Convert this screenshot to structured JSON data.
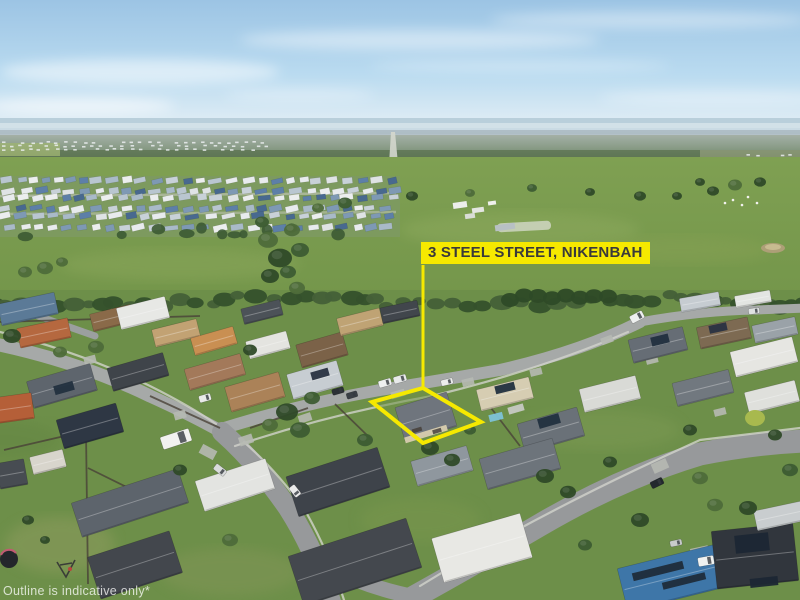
{
  "overlay": {
    "address_label": "3 STEEL STREET, NIKENBAH",
    "disclaimer": "Outline is indicative only*",
    "colors": {
      "highlight": "#f6e900",
      "label_bg": "#f6e900",
      "label_text": "#3a3a3a",
      "watermark": "rgba(255,255,255,0.75)"
    }
  },
  "scene": {
    "outline": {
      "points": "423,388 481,422 423,443 372,402",
      "leader": [
        423,
        265,
        423,
        388
      ],
      "stroke_width": 4
    },
    "estate": {
      "rows": [
        181.5,
        190,
        198.5,
        207.5,
        217,
        226.5
      ],
      "x0": 2,
      "x1": 396,
      "palette": [
        "#e8ebed",
        "#c8d1d8",
        "#5d7fa8",
        "#48698f",
        "#a9bac8",
        "#dfe3e4",
        "#7e99b4",
        "#eceeee",
        "#b9c6d0"
      ]
    },
    "houses": [
      [
        28,
        309,
        58,
        22,
        -12,
        "#5b7a97"
      ],
      [
        44,
        333,
        52,
        20,
        -12,
        "#b5683f"
      ],
      [
        112,
        318,
        42,
        18,
        -14,
        "#8a6a49"
      ],
      [
        143,
        313,
        50,
        22,
        -14,
        "#e7e8e5"
      ],
      [
        176,
        333,
        46,
        18,
        -14,
        "#c2a273"
      ],
      [
        214,
        341,
        44,
        18,
        -16,
        "#c98f52"
      ],
      [
        262,
        312,
        40,
        16,
        -14,
        "#4c5258"
      ],
      [
        268,
        345,
        42,
        18,
        -15,
        "#e4e4e0"
      ],
      [
        322,
        350,
        48,
        24,
        -16,
        "#7b6248"
      ],
      [
        360,
        322,
        44,
        18,
        -14,
        "#bfa374"
      ],
      [
        400,
        312,
        38,
        16,
        -12,
        "#41464c"
      ],
      [
        215,
        372,
        58,
        22,
        -16,
        "#a3795a"
      ],
      [
        255,
        392,
        56,
        26,
        -16,
        "#ab8258"
      ],
      [
        315,
        380,
        52,
        26,
        -16,
        "#c7cdd2"
      ],
      [
        505,
        394,
        54,
        22,
        -14,
        "#d6cdb2"
      ],
      [
        551,
        430,
        62,
        30,
        -16,
        "#6a7178"
      ],
      [
        610,
        394,
        58,
        24,
        -14,
        "#d9dad6"
      ],
      [
        658,
        345,
        56,
        24,
        -14,
        "#666d75"
      ],
      [
        724,
        333,
        52,
        22,
        -12,
        "#7d6a52"
      ],
      [
        700,
        302,
        40,
        14,
        -10,
        "#c6ccd1"
      ],
      [
        753,
        299,
        36,
        12,
        -10,
        "#e3e5e2"
      ],
      [
        775,
        330,
        44,
        18,
        -12,
        "#9aa2a8"
      ],
      [
        764,
        357,
        64,
        26,
        -14,
        "#e6e6e2"
      ],
      [
        703,
        388,
        58,
        24,
        -14,
        "#71787f"
      ],
      [
        772,
        397,
        52,
        22,
        -14,
        "#dfe0dc"
      ],
      [
        62,
        386,
        66,
        28,
        -16,
        "#5e656d"
      ],
      [
        138,
        372,
        58,
        24,
        -16,
        "#3f444a"
      ],
      [
        90,
        426,
        62,
        30,
        -16,
        "#2e3744"
      ],
      [
        15,
        408,
        36,
        26,
        -8,
        "#b55f38"
      ],
      [
        130,
        503,
        112,
        36,
        -18,
        "#5d646c"
      ],
      [
        135,
        565,
        86,
        44,
        -18,
        "#43474d"
      ],
      [
        48,
        462,
        34,
        18,
        -14,
        "#d8d5cc"
      ],
      [
        12,
        474,
        28,
        26,
        -10,
        "#474c52"
      ],
      [
        235,
        485,
        74,
        32,
        -18,
        "#e3e4e1"
      ],
      [
        338,
        482,
        96,
        42,
        -18,
        "#3e434a"
      ],
      [
        355,
        562,
        124,
        52,
        -18,
        "#44484e"
      ],
      [
        482,
        548,
        92,
        46,
        -16,
        "#e8e8e4"
      ],
      [
        520,
        464,
        76,
        32,
        -16,
        "#6d747b"
      ],
      [
        442,
        466,
        58,
        26,
        -16,
        "#8f979e"
      ],
      [
        675,
        577,
        108,
        44,
        -14,
        "#3e76a8"
      ],
      [
        755,
        556,
        82,
        58,
        -6,
        "#31363d"
      ],
      [
        779,
        516,
        48,
        20,
        -12,
        "#c9cdcf"
      ],
      [
        426,
        417,
        54,
        36,
        -17,
        "#6f757d"
      ]
    ],
    "house_details": [
      [
        426,
        434,
        44,
        6,
        -17,
        "#d8cdaf"
      ],
      [
        417,
        430,
        10,
        4,
        -17,
        "#4a4540"
      ],
      [
        437,
        431,
        9,
        4,
        -17,
        "#565049"
      ],
      [
        505,
        388,
        20,
        8,
        -14,
        "#22303f"
      ],
      [
        549,
        421,
        22,
        10,
        -16,
        "#22303f"
      ],
      [
        660,
        340,
        18,
        9,
        -14,
        "#22303f"
      ],
      [
        718,
        328,
        18,
        8,
        -12,
        "#2a3342"
      ],
      [
        64,
        388,
        20,
        9,
        -16,
        "#22303f"
      ],
      [
        658,
        571,
        52,
        8,
        -14,
        "#1f2c3a"
      ],
      [
        684,
        581,
        44,
        7,
        -14,
        "#1f2c3a"
      ],
      [
        752,
        543,
        34,
        18,
        -6,
        "#1c2734"
      ],
      [
        764,
        582,
        28,
        9,
        -6,
        "#1c2734"
      ],
      [
        496,
        417,
        14,
        7,
        -14,
        "#7ec3d8"
      ],
      [
        516,
        409,
        16,
        7,
        -16,
        "#c7c9c4"
      ],
      [
        320,
        374,
        18,
        8,
        -16,
        "#2a3342"
      ]
    ],
    "trees": [
      [
        268,
        240,
        10
      ],
      [
        280,
        258,
        12
      ],
      [
        270,
        276,
        9
      ],
      [
        292,
        230,
        8
      ],
      [
        300,
        250,
        9
      ],
      [
        288,
        272,
        8
      ],
      [
        262,
        222,
        7
      ],
      [
        297,
        288,
        8
      ],
      [
        318,
        208,
        6
      ],
      [
        345,
        203,
        7
      ],
      [
        412,
        196,
        6
      ],
      [
        470,
        193,
        5
      ],
      [
        532,
        188,
        5
      ],
      [
        590,
        192,
        5
      ],
      [
        640,
        196,
        6
      ],
      [
        677,
        196,
        5
      ],
      [
        713,
        191,
        6
      ],
      [
        735,
        185,
        7
      ],
      [
        760,
        182,
        6
      ],
      [
        700,
        182,
        5
      ],
      [
        45,
        268,
        8
      ],
      [
        25,
        272,
        7
      ],
      [
        62,
        262,
        6
      ],
      [
        12,
        336,
        9
      ],
      [
        60,
        352,
        7
      ],
      [
        96,
        347,
        8
      ],
      [
        250,
        350,
        7
      ],
      [
        287,
        412,
        11
      ],
      [
        300,
        430,
        10
      ],
      [
        270,
        425,
        8
      ],
      [
        312,
        398,
        8
      ],
      [
        430,
        448,
        9
      ],
      [
        452,
        460,
        8
      ],
      [
        545,
        476,
        9
      ],
      [
        610,
        462,
        7
      ],
      [
        568,
        492,
        8
      ],
      [
        640,
        520,
        9
      ],
      [
        700,
        478,
        8
      ],
      [
        748,
        508,
        9
      ],
      [
        790,
        470,
        8
      ],
      [
        230,
        540,
        8
      ],
      [
        180,
        470,
        7
      ],
      [
        365,
        440,
        8
      ],
      [
        470,
        430,
        6
      ],
      [
        690,
        430,
        7
      ],
      [
        775,
        435,
        7
      ],
      [
        715,
        505,
        8
      ],
      [
        585,
        545,
        7
      ],
      [
        28,
        520,
        6
      ],
      [
        45,
        540,
        5
      ]
    ],
    "lime_tree": [
      755,
      418,
      10,
      "#a8b94e"
    ],
    "vehicles": [
      [
        176,
        439,
        30,
        13,
        -18,
        "#f2f2ef"
      ],
      [
        385,
        383,
        13,
        7,
        -16,
        "#eef0f0"
      ],
      [
        400,
        379,
        13,
        7,
        -16,
        "#e8eaea"
      ],
      [
        447,
        382,
        12,
        6,
        -14,
        "#eceeec"
      ],
      [
        205,
        398,
        12,
        7,
        -16,
        "#e9ebe9"
      ],
      [
        338,
        391,
        12,
        6,
        -16,
        "#2c3136"
      ],
      [
        352,
        395,
        11,
        6,
        -16,
        "#3a3f45"
      ],
      [
        220,
        470,
        13,
        7,
        38,
        "#d9dbdb"
      ],
      [
        295,
        491,
        12,
        7,
        52,
        "#eaeaea"
      ],
      [
        637,
        317,
        14,
        8,
        -28,
        "#eef0ef"
      ],
      [
        657,
        483,
        13,
        7,
        -26,
        "#23282e"
      ],
      [
        706,
        561,
        16,
        9,
        -10,
        "#eff1f0"
      ],
      [
        676,
        543,
        12,
        6,
        -12,
        "#c8cbcb"
      ],
      [
        754,
        311,
        11,
        6,
        -8,
        "#dfe2e2"
      ]
    ],
    "driveways": [
      [
        208,
        452,
        16,
        10,
        28
      ],
      [
        246,
        440,
        14,
        9,
        -18
      ],
      [
        305,
        418,
        13,
        8,
        -18
      ],
      [
        398,
        394,
        14,
        7,
        -16
      ],
      [
        468,
        382,
        12,
        7,
        -14
      ],
      [
        536,
        372,
        12,
        7,
        -14
      ],
      [
        607,
        340,
        12,
        7,
        -20
      ],
      [
        660,
        466,
        16,
        10,
        -24
      ],
      [
        700,
        553,
        18,
        12,
        -12
      ],
      [
        180,
        415,
        12,
        8,
        -16
      ],
      [
        90,
        360,
        12,
        8,
        -14
      ],
      [
        652,
        360,
        12,
        7,
        -14
      ],
      [
        720,
        412,
        12,
        7,
        -14
      ],
      [
        736,
        574,
        20,
        24,
        -4
      ]
    ],
    "fences": [
      [
        86,
        432,
        88,
        584
      ],
      [
        4,
        450,
        82,
        432
      ],
      [
        88,
        468,
        165,
        506
      ],
      [
        150,
        396,
        220,
        428
      ],
      [
        250,
        428,
        308,
        408
      ],
      [
        488,
        404,
        520,
        446
      ],
      [
        0,
        322,
        200,
        316
      ],
      [
        335,
        404,
        372,
        440
      ]
    ],
    "cattle": [
      [
        733,
        200
      ],
      [
        742,
        205
      ],
      [
        757,
        203
      ],
      [
        748,
        197
      ],
      [
        725,
        203
      ]
    ],
    "farm_buildings": [
      [
        460,
        205,
        14,
        6,
        "#eceeea"
      ],
      [
        478,
        210,
        12,
        5,
        "#e4e6e2"
      ],
      [
        470,
        216,
        10,
        5,
        "#d9dcd6"
      ],
      [
        492,
        203,
        8,
        4,
        "#eff0ec"
      ],
      [
        505,
        227,
        20,
        6,
        "#b8c0c4"
      ]
    ]
  }
}
